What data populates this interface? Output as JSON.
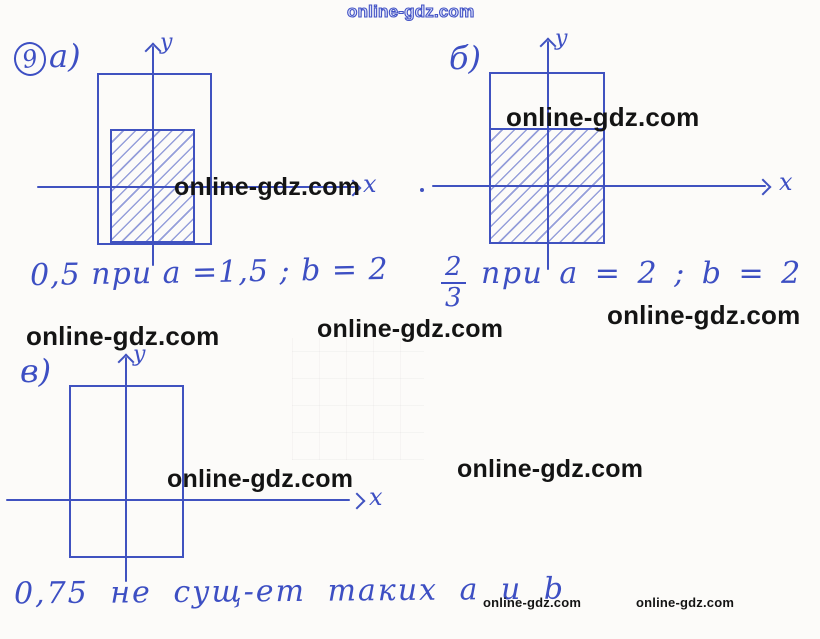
{
  "site_watermark": {
    "text": "online-gdz.com"
  },
  "colors": {
    "ink_blue": "#3d4fc3",
    "watermark_black": "#141414",
    "watermark_outline_blue": "#4353c5",
    "paper": "#fcfbf9"
  },
  "problem": {
    "number": "9"
  },
  "panels": {
    "a": {
      "label": "а)",
      "y_label": "y",
      "x_label": "x",
      "caption": "0,5 при a =1,5 ; b = 2"
    },
    "b": {
      "label": "б)",
      "y_label": "y",
      "x_label": "x",
      "fraction": {
        "numerator": "2",
        "denominator": "3"
      },
      "caption": "при a = 2 ; b = 2"
    },
    "v": {
      "label": "в)",
      "y_label": "y",
      "x_label": "x",
      "caption": "0,75 не сущ-ет таких a и b"
    }
  }
}
